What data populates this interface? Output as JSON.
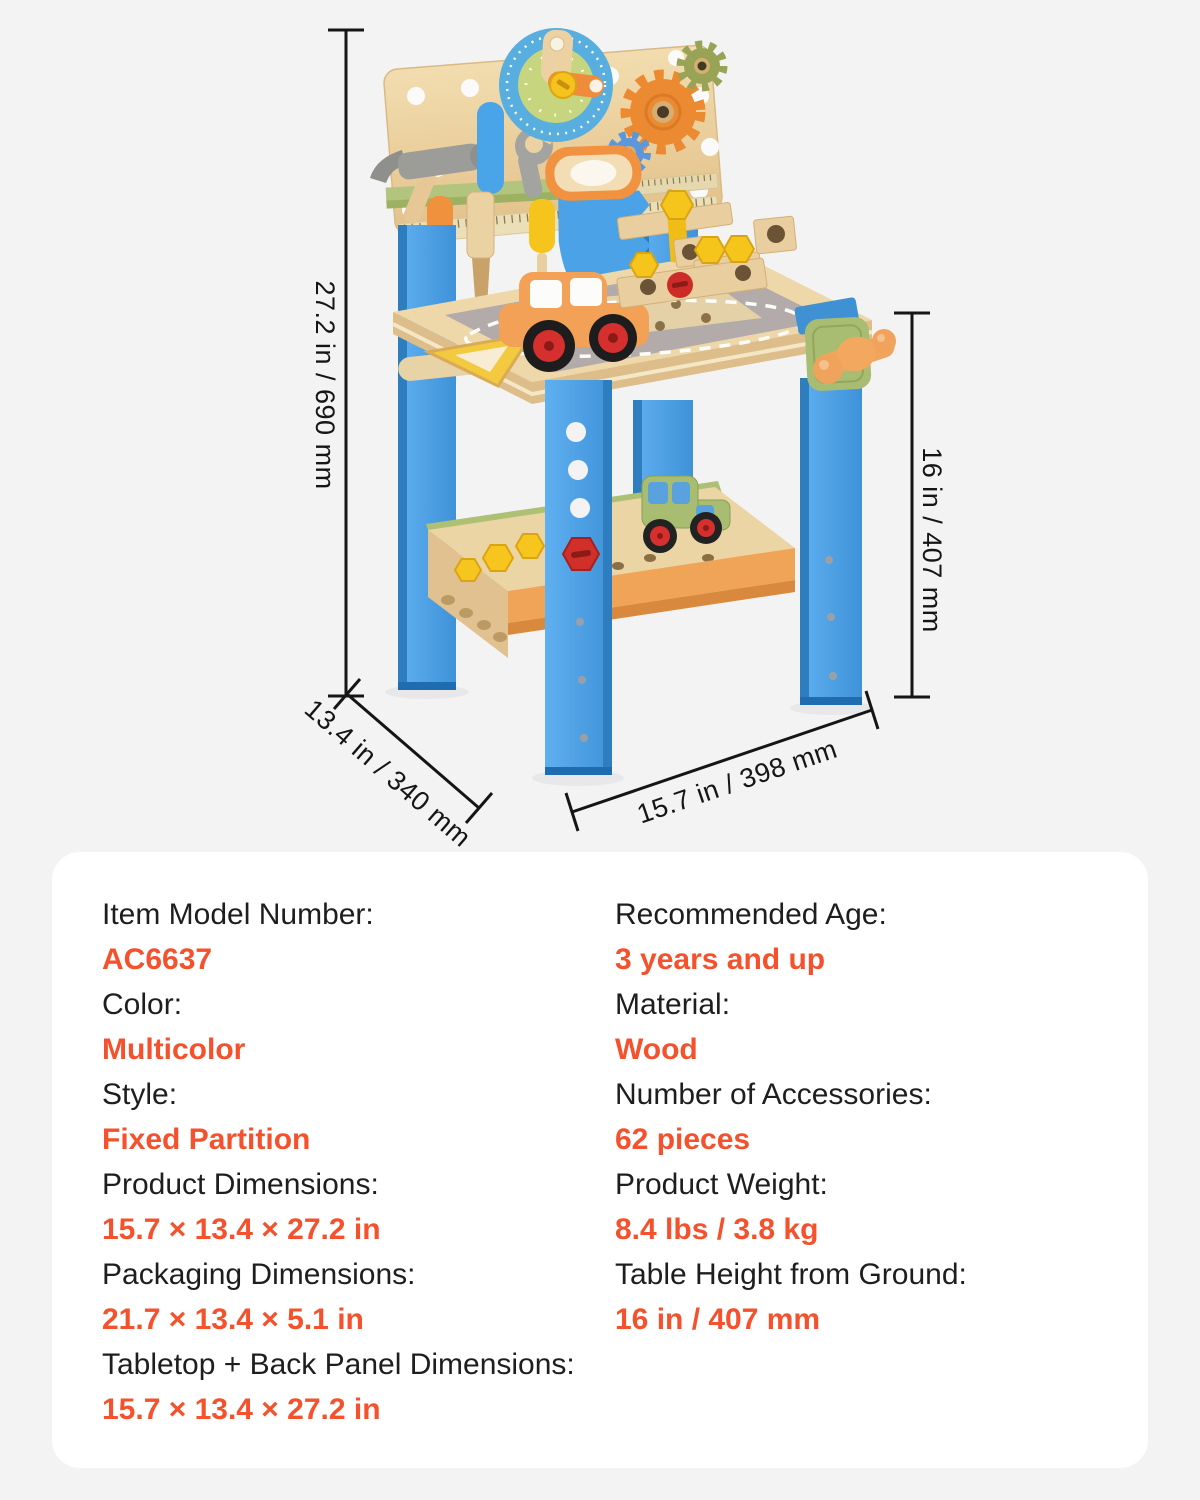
{
  "product_figure": {
    "dimension_labels": {
      "height": "27.2 in / 690 mm",
      "depth": "13.4 in / 340 mm",
      "width": "15.7 in / 398 mm",
      "table_height": "16 in / 407 mm"
    }
  },
  "specs": {
    "left_column": [
      {
        "label": "Item Model Number:",
        "value": "AC6637"
      },
      {
        "label": "Color:",
        "value": "Multicolor"
      },
      {
        "label": "Style:",
        "value": "Fixed Partition"
      },
      {
        "label": "Product Dimensions:",
        "value": "15.7 × 13.4 × 27.2 in"
      },
      {
        "label": "Packaging Dimensions:",
        "value": "21.7 × 13.4 × 5.1 in"
      },
      {
        "label": "Tabletop + Back Panel Dimensions:",
        "value": "15.7 × 13.4 × 27.2 in"
      }
    ],
    "right_column": [
      {
        "label": "Recommended Age:",
        "value": "3 years and up"
      },
      {
        "label": "Material:",
        "value": "Wood"
      },
      {
        "label": "Number of Accessories:",
        "value": "62 pieces"
      },
      {
        "label": "Product Weight:",
        "value": "8.4 lbs / 3.8 kg"
      },
      {
        "label": "Table Height from Ground:",
        "value": "16 in / 407 mm"
      }
    ]
  },
  "colors": {
    "page_background": "#f3f3f4",
    "card_background": "#ffffff",
    "accent_orange": "#f4512c",
    "text_black": "#1e1e20",
    "dimension_line": "#151515"
  }
}
